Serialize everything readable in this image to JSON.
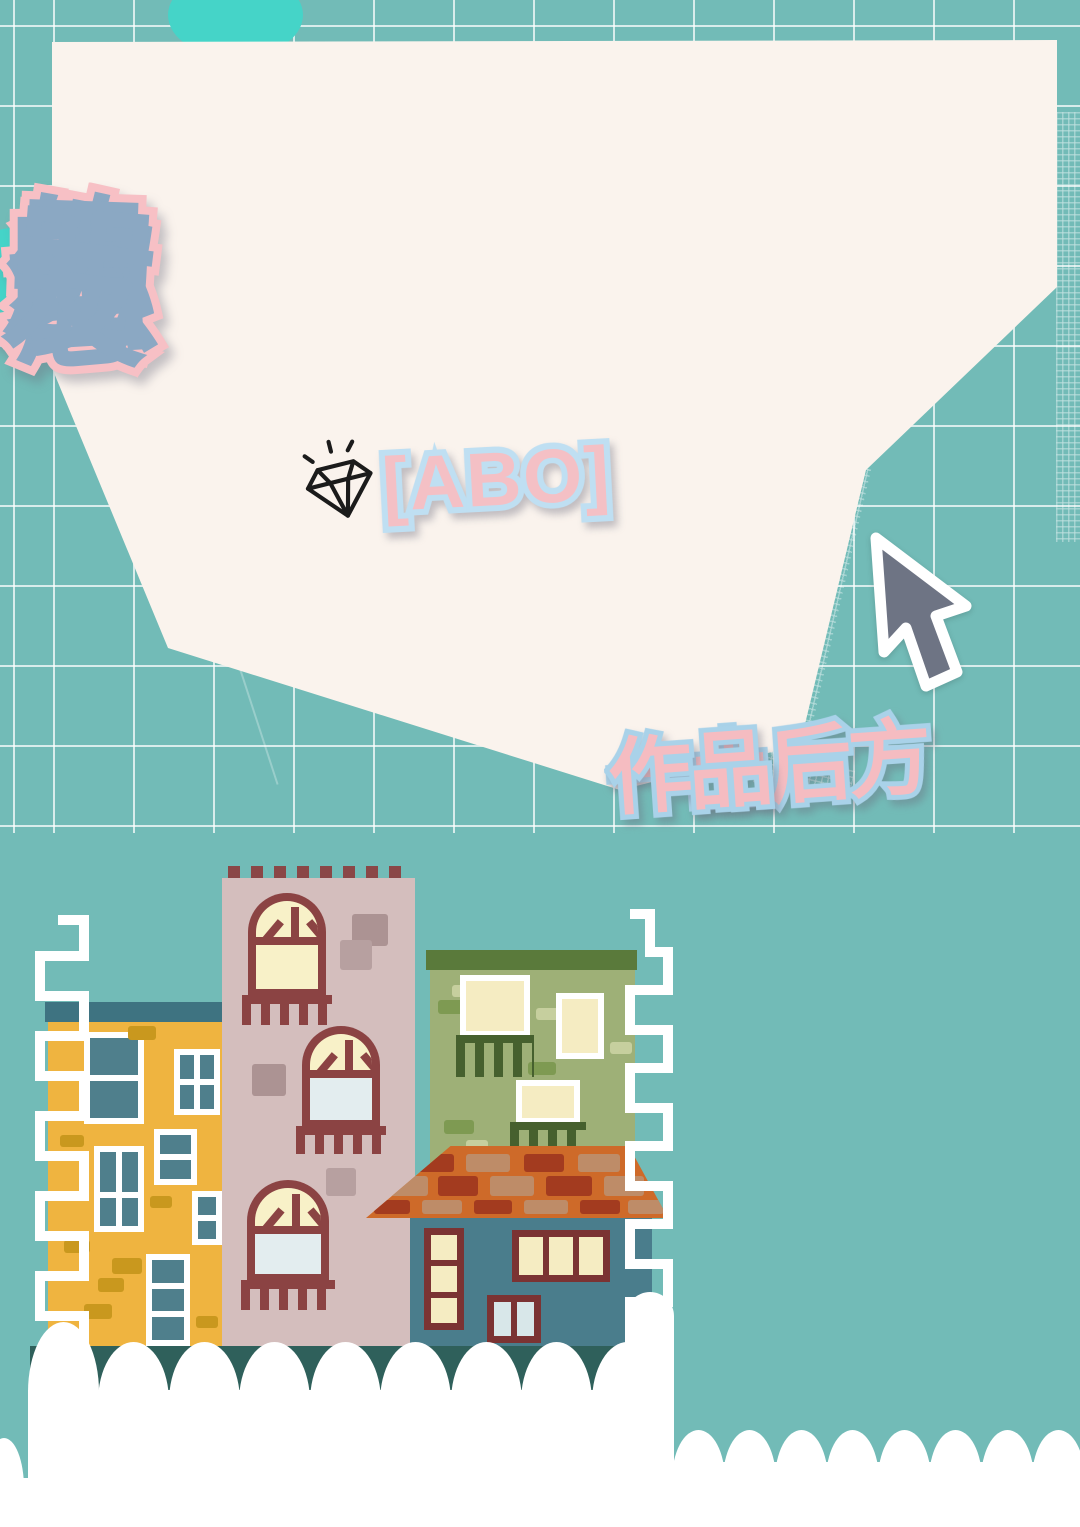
{
  "cover": {
    "title": {
      "text": "想当你的男朋友",
      "fill": "#8BA8C3",
      "outline": "#F7C0C5"
    },
    "genre_tag": {
      "text": "[ABO]",
      "fill": "#F4C0C5",
      "outline": "#BFDFF2"
    },
    "byline": {
      "author": "一土后方",
      "suffix": "作品",
      "fill": "#F5BCC1",
      "outline": "#A9D2E9"
    },
    "icons": {
      "diamond": "diamond-sparkle-icon",
      "cursor": "mouse-cursor-icon"
    }
  },
  "palette": {
    "background": "#72BBB7",
    "grid_line": "#FFFFFF",
    "paper": "#FAF3ED",
    "accent_cyan": "#45D4C8",
    "cursor_gray": "#6E7484",
    "building_yellow": "#EFB440",
    "building_pink": "#D4BEBD",
    "building_green": "#9EB077",
    "building_teal": "#4A7D8C",
    "roof_orange": "#CE6A29",
    "brick_dark": "#A33B1F",
    "brick_tan": "#BE8C68",
    "window_teal": "#4F7F8C",
    "window_cream": "#F5ECC2",
    "window_blue": "#D8E7E9",
    "frame_red": "#8B4343",
    "olive_dark": "#46602E",
    "scallop_white": "#FFFFFF",
    "gap_dark": "#2F605B"
  },
  "title_char_offsets": {
    "ty": [
      36,
      20,
      8,
      2,
      2,
      10,
      26
    ],
    "rot": [
      -5,
      -3.5,
      -2,
      0,
      2,
      4.5,
      7
    ]
  }
}
